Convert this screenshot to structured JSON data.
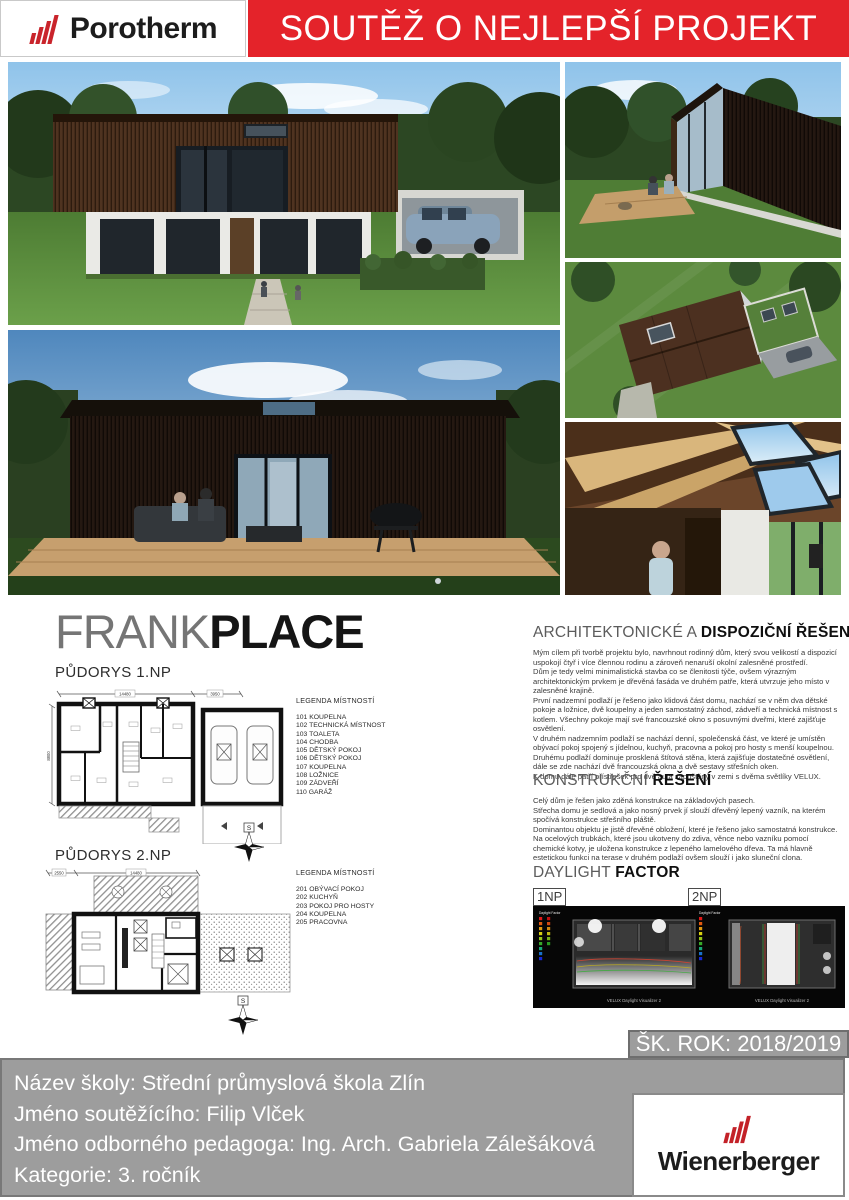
{
  "header": {
    "brand_porotherm": "Porotherm",
    "banner": "SOUTĚŽ O NEJLEPŠÍ PROJEKT"
  },
  "title": {
    "part1": "FRANK",
    "part2": "PLACE"
  },
  "plans": {
    "plan1": {
      "heading": "PŮDORYS 1.NP",
      "legend_title": "LEGENDA MÍSTNOSTÍ",
      "items": [
        "101 KOUPELNA",
        "102 TECHNICKÁ MÍSTNOST",
        "103 TOALETA",
        "104 CHODBA",
        "105 DĚTSKÝ POKOJ",
        "106 DĚTSKÝ POKOJ",
        "107 KOUPELNA",
        "108 LOŽNICE",
        "109 ZÁDVEŘÍ",
        "110 GARÁŽ"
      ],
      "dims": {
        "top": "14480",
        "top_right": "3950",
        "left": "8800"
      },
      "compass": "S"
    },
    "plan2": {
      "heading": "PŮDORYS 2.NP",
      "legend_title": "LEGENDA MÍSTNOSTÍ",
      "items": [
        "201 OBÝVACÍ POKOJ",
        "202 KUCHYŇ",
        "203 POKOJ PRO HOSTY",
        "204 KOUPELNA",
        "205 PRACOVNA"
      ],
      "dims": {
        "top_left": "2550",
        "top": "14480"
      },
      "compass": "S"
    }
  },
  "sections": {
    "arch": {
      "heading_regular": "ARCHITEKTONICKÉ A ",
      "heading_bold": "DISPOZIČNÍ ŘEŠENÍ",
      "paragraphs": [
        "Mým cílem při tvorbě projektu bylo, navrhnout rodinný dům, který svou velikostí a dispozicí uspokojí čtyř i více člennou rodinu a zároveň nenaruší okolní zalesněné prostředí.",
        "Dům je tedy velmi minimalistická stavba co se členitosti týče, ovšem výrazným architektonickým prvkem je dřevěná fasáda ve druhém patře, která utvrzuje jeho místo v zalesněné krajině.",
        "První nadzemní podlaží je řešeno jako klidová část domu, nachází se v něm dva dětské pokoje a ložnice, dvě koupelny a jeden samostatný záchod, zádveří a technická místnost s kotlem. Všechny pokoje mají své francouzské okno s posuvnými dveřmi, které zajišťuje osvětlení.",
        "V druhém nadzemním podlaží se nachází denní, společenská část, ve které je umístěn obývací pokoj spojený s jídelnou, kuchyň, pracovna a pokoj pro hosty s menší koupelnou.",
        "Druhému podlaží dominuje prosklená štítová stěna, která zajišťuje dostatečné osvětlení, dále se zde nachází dvě francouzská okna a dvě sestavy střešních oken.",
        "K domu dále patří přístřešek pro dvě auta zapuštěný v zemi s dvěma světlíky VELUX."
      ]
    },
    "constr": {
      "heading_regular": "KONSTRUKČNÍ ",
      "heading_bold": "ŘEŠENÍ",
      "paragraphs": [
        "Celý dům je řešen jako zděná konstrukce na základových pasech.",
        "Střecha domu je sedlová a jako nosný prvek jí slouží dřevěný lepený vazník, na kterém spočívá konstrukce střešního pláště.",
        "Dominantou objektu je jistě dřevěné obložení, které je řešeno jako samostatná konstrukce.",
        "Na ocelových trubkách, které jsou ukotveny do zdiva, věnce nebo vazníku pomocí chemické kotvy, je uložena konstrukce z lepeného lamelového dřeva. Ta má hlavně estetickou funkci na terase v druhém podlaží ovšem slouží i jako sluneční clona."
      ]
    },
    "daylight": {
      "heading_regular": "DAYLIGHT ",
      "heading_bold": "FACTOR",
      "label_1np": "1NP",
      "label_2np": "2NP",
      "legend_title": "Daylight Factor",
      "caption": "VELUX Daylight Visualizer 2"
    }
  },
  "footer": {
    "school_year": "ŠK. ROK: 2018/2019",
    "lines": [
      "Název školy: Střední průmyslová škola Zlín",
      "Jméno soutěžícího: Filip Vlček",
      "Jméno odborného pedagoga: Ing. Arch. Gabriela Zálešáková",
      "Kategorie: 3. ročník"
    ],
    "brand_wienerberger": "Wienerberger"
  },
  "colors": {
    "banner_red": "#e4232a",
    "brand_red": "#c32128",
    "bar_grey": "#9d9d9d",
    "title_grey": "#757575"
  }
}
